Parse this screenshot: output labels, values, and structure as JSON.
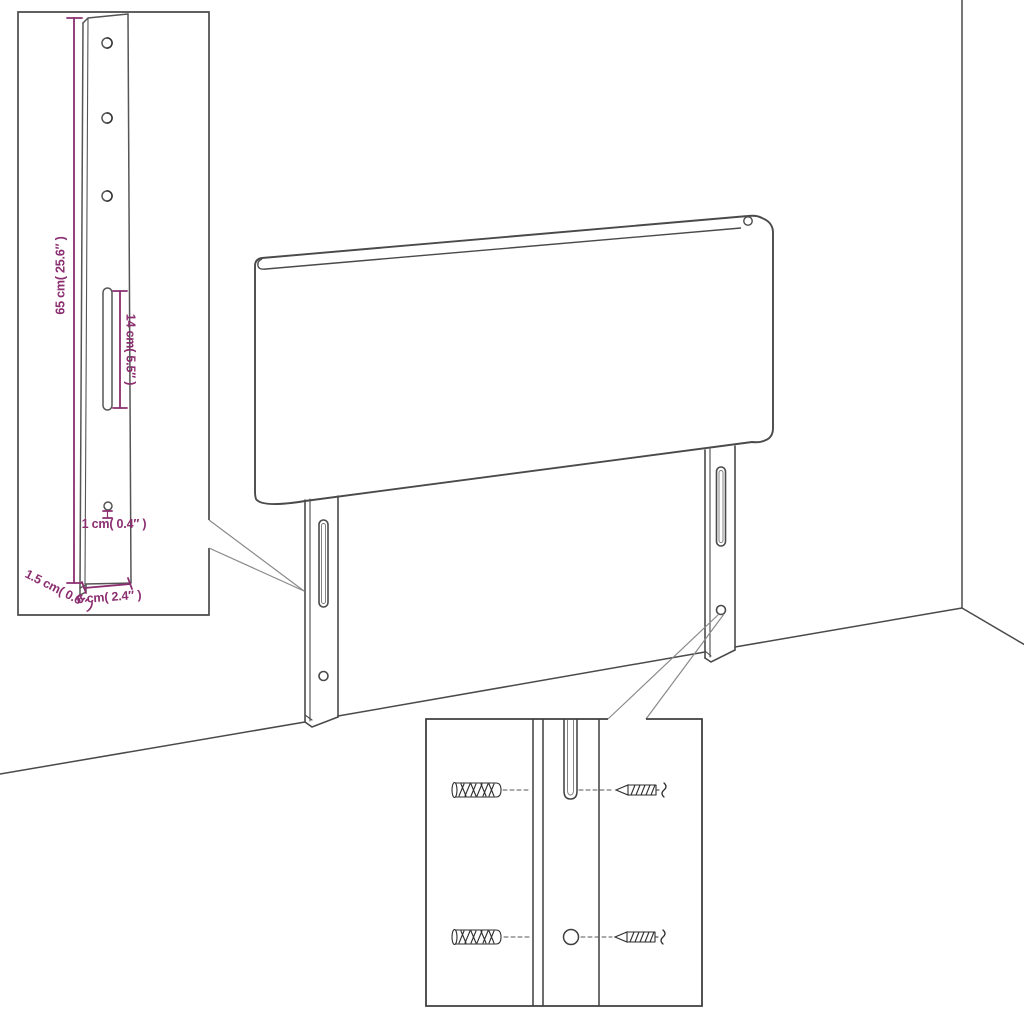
{
  "colors": {
    "line": "#4a4a4a",
    "callout": "#8a8a8a",
    "dimension": "#8b2e70",
    "background": "#ffffff"
  },
  "labels": {
    "bracket_height": "65 cm( 25.6″ )",
    "slot_length": "14 cm( 5.5″ )",
    "hole_diameter": "1 cm( 0.4″ )",
    "bracket_thickness": "1.5 cm( 0.6″ )",
    "bracket_width": "6 cm( 2.4″ )"
  }
}
